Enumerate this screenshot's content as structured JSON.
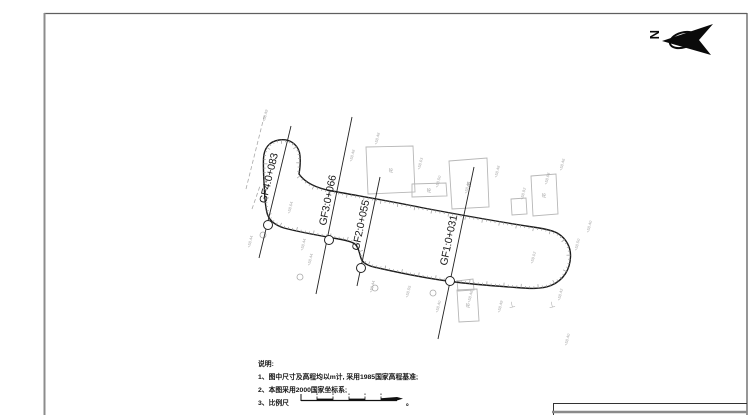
{
  "compass": {
    "letter": "N"
  },
  "notes": {
    "title": "说明:",
    "items": [
      "1、图中尺寸及高程均以m计, 采用1985国家高程基准;",
      "2、本图采用2000国家坐标系;"
    ],
    "scale_label": "3、比例尺",
    "scale_suffix": "。"
  },
  "plan": {
    "colors": {
      "road": "#1b1b1b",
      "hatch": "#9c9c9c",
      "building": "#b7b7b7",
      "annotation": "#a9a9a9",
      "section": "#222222"
    },
    "road_path": "M 299,174 C 306,184 318,188.5 332,191 C 362,196.5 392,201.5 421,207.5 C 458,214.5 497,221.5 536,227.5 C 546,229 553,230.5 558,233.5 C 566,238.5 571,247 570.5,257 C 570,269 564,280 551,285.5 C 541,289.5 528,288.5 516,287.5 C 495,286 473,284.5 451,281.5 C 424,278 398,272.5 376,267.5 C 372,266.8 364,264.5 361.5,259.5 C 359.5,255 359.5,249 355.5,244.5 C 352.5,241.5 343,239.5 333,238 C 316,235 299,232 284,228 C 276,225.5 270,221.5 267.5,214.5 C 265.5,208.5 265,201 264.5,192 C 264,181 263,170 263.5,158.5 C 264,148.5 269,141.5 279,140 C 289,138.5 297,143.5 299.5,152.5 C 301,159.5 300,168 299,174 Z",
    "sections": [
      {
        "label": "GF4:0+083",
        "line": [
          291,
          126,
          259,
          258
        ],
        "circle": [
          268,
          225
        ],
        "label_pos": [
          272,
          179
        ]
      },
      {
        "label": "GF3:0+066",
        "line": [
          352,
          117,
          316,
          294
        ],
        "circle": [
          329,
          240
        ],
        "label_pos": [
          331,
          201
        ]
      },
      {
        "label": "GF2:0+055",
        "line": [
          380,
          177,
          357,
          286
        ],
        "circle": [
          361,
          268
        ],
        "label_pos": [
          364,
          226
        ]
      },
      {
        "label": "GF1:0+031",
        "line": [
          474,
          167,
          438,
          339
        ],
        "circle": [
          450,
          281
        ],
        "label_pos": [
          452,
          241
        ]
      }
    ],
    "buildings": [
      {
        "path": "M366,147 L413,146 L415,192 L368,194 Z",
        "label": "砼",
        "lx": 391,
        "ly": 172
      },
      {
        "path": "M412,184 L446,183 L447,196 L412,197 Z",
        "label": "砼",
        "lx": 429,
        "ly": 192
      },
      {
        "path": "M449,161 L487,158 L489,207 L452,209 Z",
        "label": "砼",
        "lx": 469,
        "ly": 186
      },
      {
        "path": "M531,176 L556,174 L558,214 L533,216 Z",
        "label": "砼",
        "lx": 544,
        "ly": 197
      },
      {
        "path": "M511,199 L526,198 L527,214 L512,215 Z",
        "label": "",
        "lx": 0,
        "ly": 0
      },
      {
        "path": "M457,290 L477,289 L479,321 L459,322 Z",
        "label": "砼",
        "lx": 468,
        "ly": 307
      },
      {
        "path": "M457,281 L473,279 L474,290 L458,291 Z",
        "label": "",
        "lx": 0,
        "ly": 0
      }
    ],
    "trees": [
      [
        263,
        235
      ],
      [
        300,
        277
      ],
      [
        375,
        288
      ],
      [
        433,
        293
      ]
    ],
    "dashed_lines": [
      [
        246,
        189,
        265,
        113
      ],
      [
        252,
        209,
        260,
        186
      ]
    ],
    "tee_glyph": "⊥",
    "tee_marks": [
      [
        509,
        308
      ],
      [
        549,
        308
      ]
    ],
    "spot_elevations": [
      [
        265,
        122,
        "+58.49"
      ],
      [
        250,
        248,
        "+58.44"
      ],
      [
        303,
        251,
        "+58.44"
      ],
      [
        290,
        214,
        "+58.64"
      ],
      [
        352,
        162,
        "+58.48"
      ],
      [
        377,
        145,
        "+58.48"
      ],
      [
        420,
        170,
        "+58.63"
      ],
      [
        438,
        188,
        "+58.50"
      ],
      [
        467,
        194,
        "+58.48"
      ],
      [
        497,
        178,
        "+58.48"
      ],
      [
        523,
        200,
        "+58.92"
      ],
      [
        547,
        185,
        "+58.68"
      ],
      [
        562,
        171,
        "+58.46"
      ],
      [
        589,
        233,
        "+58.40"
      ],
      [
        577,
        251,
        "+58.50"
      ],
      [
        533,
        264,
        "+59.02"
      ],
      [
        470,
        303,
        "+58.46"
      ],
      [
        438,
        313,
        "+58.40"
      ],
      [
        500,
        313,
        "+58.49"
      ],
      [
        560,
        301,
        "+58.42"
      ],
      [
        372,
        293,
        "+58.44"
      ],
      [
        408,
        298,
        "+58.55"
      ],
      [
        310,
        266,
        "+58.44"
      ],
      [
        567,
        346,
        "+58.40"
      ]
    ]
  }
}
